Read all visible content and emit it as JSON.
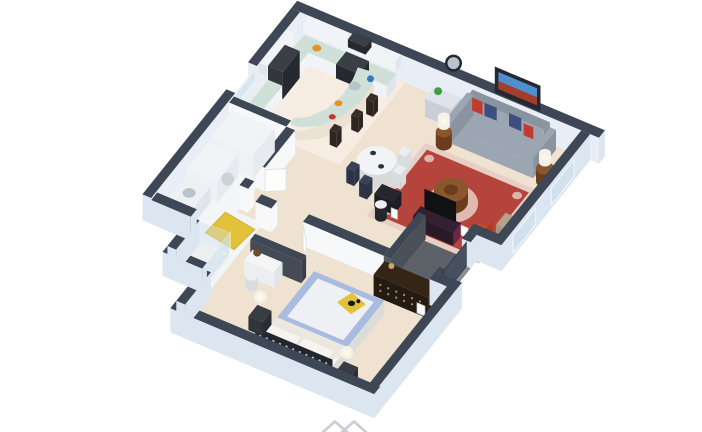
{
  "meta": {
    "description": "3D isometric cutaway floor plan rendering of a furnished one-bedroom apartment on a white background",
    "width": 702,
    "height": 432
  },
  "colors": {
    "background": "#ffffff",
    "wall_cap": "#3e4756",
    "wall_outer": "#dce6f1",
    "wall_inner": "#e9eef6",
    "wall_white": "#f6f8fa",
    "charcoal": "#4a5058",
    "door_dark": "#46505e",
    "floor_carpet": "#f0e2d1",
    "floor_kitchen": "#f6ece2",
    "floor_bath": "#f3f6f7",
    "floor_entry": "#5c6268",
    "entry_step": "#878d94",
    "rug_red": "#b5443c",
    "rug_cream": "#e8cfc5",
    "rug_center": "#a03a33",
    "mat_yellow": "#e2c23a",
    "glass": "#cfe2ee",
    "counter": "#cfe0d8",
    "cabinet": "#f1f4f6",
    "cabinet_side": "#dfe5ea",
    "island_base": "#ece2d4",
    "appliance": "#26292f",
    "appliance_top": "#3a3e45",
    "stool": "#2e2422",
    "wood": "#8a572c",
    "wood_dark": "#6b3d1d",
    "sofa": "#9ca6b2",
    "sofa_dark": "#8a94a0",
    "pillow_red": "#c23b2e",
    "pillow_navy": "#3e4e7e",
    "frame_dark": "#26282e",
    "art_sky": "#4f8fd0",
    "art_land": "#a43d2a",
    "mirror_glass": "#b9c2cf",
    "chair_navy": "#2c3347",
    "chair_navy_top": "#3a4156",
    "chair_white": "#eceef1",
    "chair_white_side": "#d8dcdf",
    "tv_black": "#101114",
    "tv_stand": "#6b2746",
    "dresser": "#241b13",
    "dresser_face": "#2f2115",
    "dresser_top": "#342517",
    "knob_gold": "#c9a86a",
    "armchair_orange": "#d9481f",
    "armchair_tan": "#b5a18c",
    "bed_duvet": "#a8bcdf",
    "duvet_center": "#eef0f4",
    "bed_white": "#f6f4ef",
    "blanket": "#ebe8e0",
    "lattice": "#23262c",
    "lattice_dot": "#d6dade",
    "nightstand": "#2a2d33",
    "nightstand_top": "#383b42",
    "lamp_white": "#f4f1e8",
    "lamp_glow": "#fff8e6",
    "plant": "#3f9e3f",
    "plant_dark": "#2e7d32",
    "cat": "#17181a",
    "fruit_orange": "#e8912a",
    "fruit_red": "#c0392b",
    "kettle_blue": "#3a78c2",
    "sink_gray": "#b9c3ca",
    "watermark": "#c9cdd3"
  },
  "scene": {
    "rooms": [
      "kitchen",
      "dining-nook",
      "living-room",
      "hallway",
      "bathroom",
      "closet",
      "bedroom",
      "entry"
    ],
    "furniture": [
      "refrigerator",
      "stove",
      "microwave",
      "upper-cabinets",
      "kitchen-counters",
      "curved-breakfast-bar",
      "bar-stools",
      "dining-table",
      "dining-chairs",
      "bar-cart",
      "round-wall-mirror",
      "sofa",
      "throw-pillows",
      "wall-art",
      "side-tables",
      "table-lamps",
      "coffee-table",
      "area-rug",
      "desk",
      "desk-chair",
      "tv",
      "tv-console",
      "accent-armchairs",
      "front-door",
      "entry-mat",
      "closet-wardrobe",
      "washer",
      "bathroom-vanity",
      "shower-enclosure",
      "potted-plant",
      "bath-mat",
      "bedroom-vanity",
      "vanity-stool",
      "dresser",
      "bed",
      "duvet",
      "cat-on-yellow-throw",
      "lattice-headboard",
      "nightstands",
      "sphere-lamps"
    ]
  },
  "watermark": {
    "glyph": "double-chevron",
    "position": "bottom-center"
  }
}
